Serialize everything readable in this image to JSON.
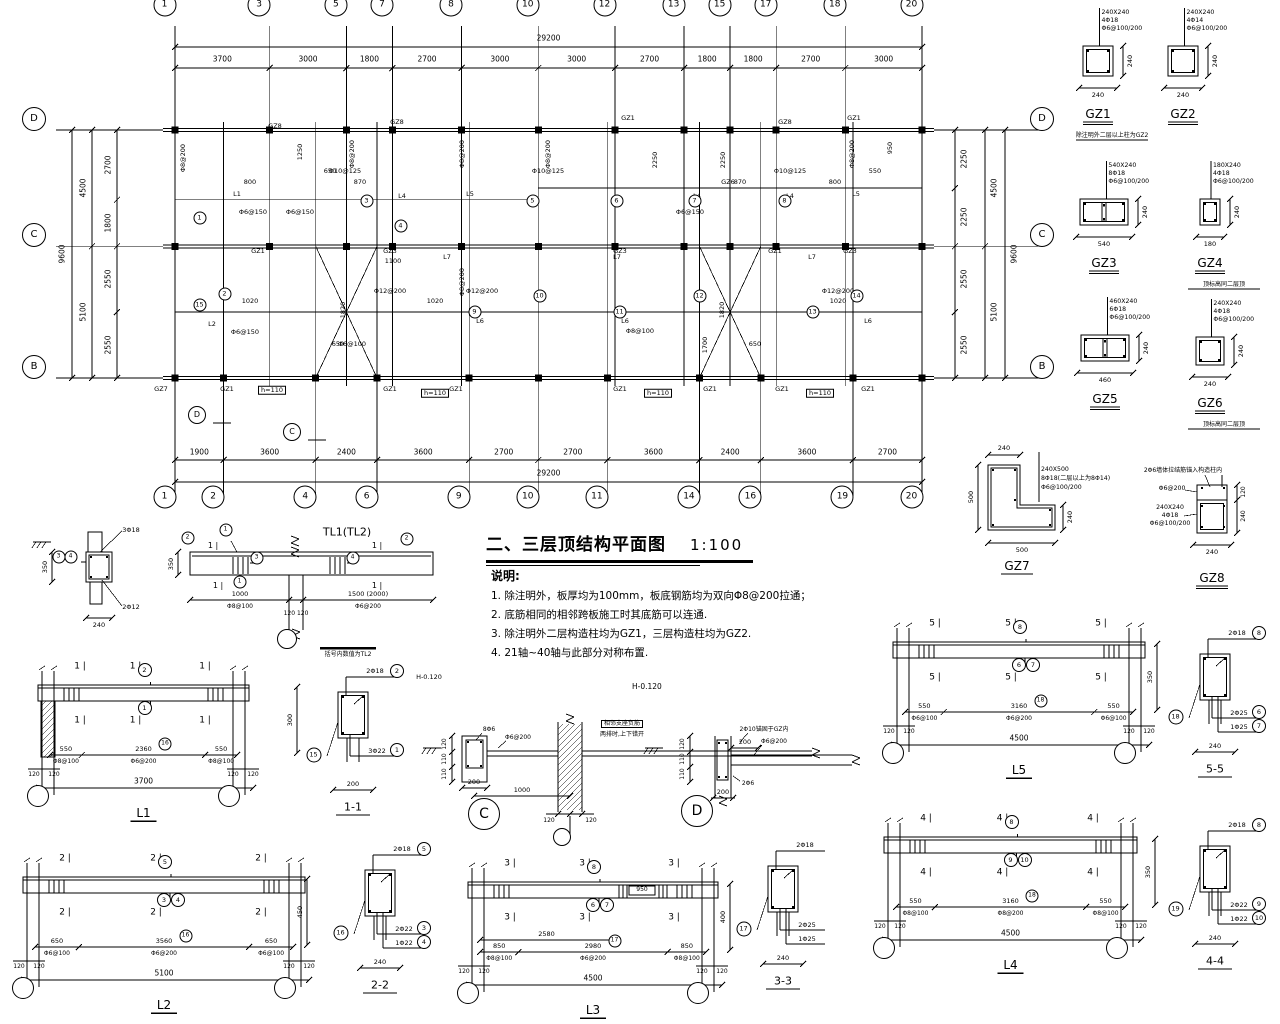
{
  "title": {
    "text": "二、三层顶结构平面图",
    "scale": "1:100"
  },
  "notes": {
    "heading": "说明:",
    "items": [
      "1. 除注明外，板厚均为100mm，板底钢筋均为双向Φ8@200拉通；",
      "2. 底筋相同的相邻跨板施工时其底筋可以连通.",
      "3. 除注明外二层构造柱均为GZ1，三层构造柱均为GZ2.",
      "4. 21轴~40轴与此部分对称布置."
    ],
    "elevation_note": "H-0.120"
  },
  "plan": {
    "total_dim": "29200",
    "height_dim": "9600",
    "top_bounds": [
      0,
      3700,
      6700,
      8500,
      11200,
      14200,
      17200,
      19900,
      21700,
      23500,
      26200,
      29200
    ],
    "top_axes": [
      "1",
      "3",
      "5",
      "7",
      "8",
      "10",
      "12",
      "13",
      "15",
      "17",
      "18",
      "20"
    ],
    "top_dims": [
      "3700",
      "3000",
      "1800",
      "2700",
      "3000",
      "3000",
      "2700",
      "1800",
      "1800",
      "2700",
      "3000"
    ],
    "bottom_bounds": [
      0,
      1900,
      5500,
      7900,
      11500,
      14200,
      16900,
      20500,
      22900,
      26500,
      29200
    ],
    "bottom_axes": [
      "1",
      "2",
      "4",
      "6",
      "9",
      "10",
      "11",
      "14",
      "16",
      "19",
      "20"
    ],
    "bottom_dims": [
      "1900",
      "3600",
      "2400",
      "3600",
      "2700",
      "2700",
      "3600",
      "2400",
      "3600",
      "2700"
    ],
    "side_axes": [
      "D",
      "C",
      "B"
    ],
    "side_mm": [
      0,
      4500,
      9600
    ],
    "left_outer": {
      "bounds": [
        0,
        4500,
        9600
      ],
      "labels": [
        "4500",
        "5100"
      ]
    },
    "left_inner": {
      "bounds": [
        0,
        2700,
        4500,
        7050,
        9600
      ],
      "labels": [
        "2700",
        "1800",
        "2550",
        "2550"
      ]
    },
    "right_inner": {
      "bounds": [
        0,
        2250,
        4500,
        7050,
        9600
      ],
      "labels": [
        "2250",
        "2250",
        "2550",
        "2550"
      ]
    },
    "right_outer": {
      "bounds": [
        0,
        4500,
        9600
      ],
      "labels": [
        "4500",
        "5100"
      ]
    },
    "stair_panels": [
      [
        5500,
        7900
      ],
      [
        20500,
        22900
      ]
    ],
    "annotations": [
      {
        "t": "GZ8",
        "x": 100,
        "y": -4
      },
      {
        "t": "GZ8",
        "x": 222,
        "y": -8
      },
      {
        "t": "GZ1",
        "x": 453,
        "y": -12
      },
      {
        "t": "GZ8",
        "x": 610,
        "y": -8
      },
      {
        "t": "GZ1",
        "x": 679,
        "y": -12
      },
      {
        "t": "L1",
        "x": 62,
        "y": 64
      },
      {
        "t": "L4",
        "x": 227,
        "y": 66
      },
      {
        "t": "L5",
        "x": 295,
        "y": 64
      },
      {
        "t": "L4",
        "x": 522,
        "y": 66
      },
      {
        "t": "GZ6",
        "x": 553,
        "y": 52
      },
      {
        "t": "L4",
        "x": 615,
        "y": 66
      },
      {
        "t": "L5",
        "x": 681,
        "y": 64
      },
      {
        "t": "GZ1",
        "x": 83,
        "y": 121
      },
      {
        "t": "GZ3",
        "x": 215,
        "y": 121
      },
      {
        "t": "GZ3",
        "x": 445,
        "y": 121
      },
      {
        "t": "GZ1",
        "x": 600,
        "y": 121
      },
      {
        "t": "GZ3",
        "x": 675,
        "y": 121
      },
      {
        "t": "L7",
        "x": 272,
        "y": 127
      },
      {
        "t": "L7",
        "x": 442,
        "y": 127
      },
      {
        "t": "L7",
        "x": 637,
        "y": 127
      },
      {
        "t": "L2",
        "x": 37,
        "y": 194
      },
      {
        "t": "L6",
        "x": 305,
        "y": 191
      },
      {
        "t": "L6",
        "x": 450,
        "y": 191
      },
      {
        "t": "L6",
        "x": 693,
        "y": 191
      },
      {
        "t": "GZ7",
        "x": -14,
        "y": 259
      },
      {
        "t": "GZ1",
        "x": 52,
        "y": 259
      },
      {
        "t": "GZ1",
        "x": 215,
        "y": 259
      },
      {
        "t": "GZ1",
        "x": 281,
        "y": 259
      },
      {
        "t": "GZ1",
        "x": 445,
        "y": 259
      },
      {
        "t": "GZ1",
        "x": 535,
        "y": 259
      },
      {
        "t": "GZ1",
        "x": 607,
        "y": 259
      },
      {
        "t": "GZ1",
        "x": 693,
        "y": 259
      },
      {
        "t": "h=110",
        "x": 97,
        "y": 260,
        "b": 1
      },
      {
        "t": "h=110",
        "x": 260,
        "y": 263,
        "b": 1
      },
      {
        "t": "h=110",
        "x": 483,
        "y": 263,
        "b": 1
      },
      {
        "t": "h=110",
        "x": 645,
        "y": 263,
        "b": 1
      },
      {
        "t": "Φ8@200",
        "x": 8,
        "y": 28,
        "r": 1
      },
      {
        "t": "Φ8@200",
        "x": 177,
        "y": 24,
        "r": 1
      },
      {
        "t": "Φ8@200",
        "x": 287,
        "y": 24,
        "r": 1
      },
      {
        "t": "Φ8@200",
        "x": 373,
        "y": 24,
        "r": 1
      },
      {
        "t": "Φ8@200",
        "x": 677,
        "y": 24,
        "r": 1
      },
      {
        "t": "Φ8@200",
        "x": 287,
        "y": 152,
        "r": 1
      },
      {
        "t": "Φ10@125",
        "x": 170,
        "y": 41
      },
      {
        "t": "Φ10@125",
        "x": 373,
        "y": 41
      },
      {
        "t": "Φ10@125",
        "x": 615,
        "y": 41
      },
      {
        "t": "Φ6@150",
        "x": 78,
        "y": 82
      },
      {
        "t": "Φ6@150",
        "x": 125,
        "y": 82
      },
      {
        "t": "Φ6@150",
        "x": 515,
        "y": 82
      },
      {
        "t": "Φ12@200",
        "x": 215,
        "y": 161
      },
      {
        "t": "Φ12@200",
        "x": 307,
        "y": 161
      },
      {
        "t": "Φ12@200",
        "x": 663,
        "y": 161
      },
      {
        "t": "Φ8@100",
        "x": 465,
        "y": 201
      },
      {
        "t": "Φ6@100",
        "x": 177,
        "y": 214
      },
      {
        "t": "Φ6@150",
        "x": 70,
        "y": 202
      },
      {
        "t": "800",
        "x": 75,
        "y": 52
      },
      {
        "t": "870",
        "x": 185,
        "y": 52
      },
      {
        "t": "870",
        "x": 565,
        "y": 52
      },
      {
        "t": "800",
        "x": 660,
        "y": 52
      },
      {
        "t": "650",
        "x": 155,
        "y": 41
      },
      {
        "t": "650",
        "x": 163,
        "y": 214
      },
      {
        "t": "650",
        "x": 580,
        "y": 214
      },
      {
        "t": "1020",
        "x": 75,
        "y": 171
      },
      {
        "t": "1020",
        "x": 260,
        "y": 171
      },
      {
        "t": "1020",
        "x": 663,
        "y": 171
      },
      {
        "t": "1100",
        "x": 218,
        "y": 131
      },
      {
        "t": "550",
        "x": 700,
        "y": 41
      },
      {
        "t": "1250",
        "x": 125,
        "y": 22,
        "r": 1
      },
      {
        "t": "950",
        "x": 715,
        "y": 18,
        "r": 1
      },
      {
        "t": "2250",
        "x": 480,
        "y": 30,
        "r": 1
      },
      {
        "t": "2250",
        "x": 548,
        "y": 30,
        "r": 1
      },
      {
        "t": "1820",
        "x": 168,
        "y": 180,
        "r": 1
      },
      {
        "t": "1820",
        "x": 547,
        "y": 180,
        "r": 1
      },
      {
        "t": "1700",
        "x": 530,
        "y": 215,
        "r": 1
      },
      {
        "t": "1",
        "x": 30,
        "y": 93,
        "c": 1
      },
      {
        "t": "3",
        "x": 197,
        "y": 76,
        "c": 1
      },
      {
        "t": "4",
        "x": 231,
        "y": 101,
        "c": 1
      },
      {
        "t": "5",
        "x": 363,
        "y": 76,
        "c": 1
      },
      {
        "t": "6",
        "x": 447,
        "y": 76,
        "c": 1
      },
      {
        "t": "7",
        "x": 525,
        "y": 76,
        "c": 1
      },
      {
        "t": "8",
        "x": 615,
        "y": 76,
        "c": 1
      },
      {
        "t": "2",
        "x": 55,
        "y": 169,
        "c": 1
      },
      {
        "t": "9",
        "x": 305,
        "y": 187,
        "c": 1
      },
      {
        "t": "10",
        "x": 370,
        "y": 171,
        "c": 1
      },
      {
        "t": "11",
        "x": 450,
        "y": 187,
        "c": 1
      },
      {
        "t": "12",
        "x": 530,
        "y": 171,
        "c": 1
      },
      {
        "t": "13",
        "x": 643,
        "y": 187,
        "c": 1
      },
      {
        "t": "14",
        "x": 687,
        "y": 171,
        "c": 1
      },
      {
        "t": "15",
        "x": 30,
        "y": 180,
        "c": 1
      }
    ],
    "cut_bubbles": [
      {
        "t": "D",
        "x": 30,
        "y": 293
      },
      {
        "t": "C",
        "x": 125,
        "y": 310
      }
    ]
  },
  "column_details": [
    {
      "id": "GZ1",
      "x": 1083,
      "y": 46,
      "w": 30,
      "h": 30,
      "cells": 1,
      "spec": [
        "240X240",
        "4Φ18",
        "Φ6@100/200"
      ],
      "wdim": "240",
      "hdim": "240",
      "note": "除注明外二层以上柱为GZ2"
    },
    {
      "id": "GZ2",
      "x": 1168,
      "y": 46,
      "w": 30,
      "h": 30,
      "cells": 1,
      "spec": [
        "240X240",
        "4Φ14",
        "Φ6@100/200"
      ],
      "wdim": "240",
      "hdim": "240"
    },
    {
      "id": "GZ3",
      "x": 1080,
      "y": 199,
      "w": 48,
      "h": 26,
      "cells": 2,
      "spec": [
        "540X240",
        "8Φ18",
        "Φ6@100/200"
      ],
      "wdim": "540",
      "hdim": "240"
    },
    {
      "id": "GZ4",
      "x": 1200,
      "y": 199,
      "w": 20,
      "h": 26,
      "cells": 1,
      "spec": [
        "180X240",
        "4Φ18",
        "Φ6@100/200"
      ],
      "wdim": "180",
      "hdim": "240",
      "note": "顶标高同二层顶"
    },
    {
      "id": "GZ5",
      "x": 1081,
      "y": 335,
      "w": 48,
      "h": 26,
      "cells": 2,
      "spec": [
        "460X240",
        "6Φ18",
        "Φ6@100/200"
      ],
      "wdim": "460",
      "hdim": "240"
    },
    {
      "id": "GZ6",
      "x": 1196,
      "y": 337,
      "w": 28,
      "h": 28,
      "cells": 1,
      "spec": [
        "240X240",
        "4Φ18",
        "Φ6@100/200"
      ],
      "wdim": "240",
      "hdim": "240",
      "note": "顶标高同二层顶"
    }
  ],
  "gz7": {
    "id": "GZ7",
    "spec": [
      "240X500",
      "8Φ18(二层以上为8Φ14)",
      "Φ6@100/200"
    ],
    "dim_top": "240",
    "dim_left": "500",
    "dim_bottom": "500",
    "dim_right": "240"
  },
  "gz8": {
    "id": "GZ8",
    "leader_note": "2Φ6墙体拉结筋锚入构造柱内",
    "tie": "Φ6@200",
    "spec": [
      "240X240",
      "4Φ18",
      "Φ6@100/200"
    ],
    "dim_r1": "120",
    "dim_r2": "240",
    "dim_bottom": "240"
  },
  "tl_detail": {
    "title": "TL1(TL2)",
    "top_rebar": "3Φ18",
    "bot_rebar": "2Φ12",
    "sec_h": "350",
    "sec_w": "240",
    "sec_circles": [
      "3",
      "4"
    ],
    "elev_dim_left": "350",
    "span1": "1000",
    "span1_rebar": "Φ8@100",
    "span2": "1500 (2000)",
    "span2_rebar": "Φ6@200",
    "wall_dims": "120 120",
    "note": "括号内数值为TL2",
    "marker": "1",
    "c_top_left": "2",
    "c_top_mid": "1",
    "c_top_right": "2",
    "c_st_left": "3",
    "c_st_right": "4",
    "c_bot": "1"
  },
  "beam_details": [
    {
      "id": "L1",
      "x": 26,
      "y": 655,
      "w": 235,
      "marker": "1",
      "top_circle": "2",
      "mid_circles": [
        "1"
      ],
      "segs": [
        {
          "d": "550",
          "r": "Φ8@100"
        },
        {
          "d": "2360",
          "r": "Φ6@200"
        },
        {
          "d": "550",
          "r": "Φ8@100"
        }
      ],
      "slab_circle": "16",
      "total": "3700",
      "right_dim": "300",
      "rdx": 36,
      "wall_left": true
    },
    {
      "id": "L2",
      "x": 11,
      "y": 847,
      "w": 306,
      "marker": "2",
      "top_circle": "5",
      "mid_circles": [
        "3",
        "4"
      ],
      "segs": [
        {
          "d": "650",
          "r": "Φ6@100"
        },
        {
          "d": "3560",
          "r": "Φ6@200"
        },
        {
          "d": "650",
          "r": "Φ6@100"
        }
      ],
      "slab_circle": "16",
      "total": "5100",
      "right_dim": "450",
      "rdx": -10
    },
    {
      "id": "L3",
      "x": 456,
      "y": 852,
      "w": 274,
      "marker": "3",
      "top_circle": "8",
      "mid_circles": [
        "6",
        "7"
      ],
      "segs": [
        {
          "d": "850",
          "r": "Φ8@100"
        },
        {
          "d": "2980",
          "r": "Φ6@200"
        },
        {
          "d": "850",
          "r": "Φ8@100"
        }
      ],
      "slab_circle": "17",
      "total": "4500",
      "right_dim": "400",
      "rdx": 0,
      "extra_top_dim": "2580",
      "beam_dim": "950"
    },
    {
      "id": "L5",
      "x": 881,
      "y": 612,
      "w": 276,
      "marker": "5",
      "top_circle": "8",
      "mid_circles": [
        "6",
        "7"
      ],
      "segs": [
        {
          "d": "550",
          "r": "Φ6@100"
        },
        {
          "d": "3160",
          "r": "Φ6@200"
        },
        {
          "d": "550",
          "r": "Φ6@100"
        }
      ],
      "slab_circle": "18",
      "total": "4500",
      "right_dim": "350",
      "rdx": 0
    },
    {
      "id": "L4",
      "x": 872,
      "y": 807,
      "w": 277,
      "marker": "4",
      "top_circle": "8",
      "mid_circles": [
        "9",
        "10"
      ],
      "segs": [
        {
          "d": "550",
          "r": "Φ8@100"
        },
        {
          "d": "3160",
          "r": "Φ8@200"
        },
        {
          "d": "550",
          "r": "Φ8@100"
        }
      ],
      "slab_circle": "18",
      "total": "4500",
      "right_dim": "350",
      "rdx": 6
    }
  ],
  "sections": [
    {
      "id": "1-1",
      "x": 315,
      "y": 660,
      "top": "2Φ18",
      "top_circle": "2",
      "note": "H-0.120",
      "bots": [
        {
          "t": "3Φ22",
          "c": "1"
        }
      ],
      "left_circle": "15",
      "dim": "200"
    },
    {
      "id": "2-2",
      "x": 342,
      "y": 838,
      "top": "2Φ18",
      "top_circle": "5",
      "bots": [
        {
          "t": "2Φ22",
          "c": "3"
        },
        {
          "t": "1Φ22",
          "c": "4"
        }
      ],
      "left_circle": "16",
      "dim": "240"
    },
    {
      "id": "3-3",
      "x": 745,
      "y": 834,
      "top": "2Φ18",
      "bots": [
        {
          "t": "2Φ25",
          "c": ""
        },
        {
          "t": "1Φ25",
          "c": ""
        }
      ],
      "left_circle": "17",
      "dim": "240"
    },
    {
      "id": "5-5",
      "x": 1177,
      "y": 622,
      "top": "2Φ18",
      "top_circle": "8",
      "bots": [
        {
          "t": "2Φ25",
          "c": "6"
        },
        {
          "t": "1Φ25",
          "c": "7"
        }
      ],
      "left_circle": "18",
      "dim": "240"
    },
    {
      "id": "4-4",
      "x": 1177,
      "y": 814,
      "top": "2Φ18",
      "top_circle": "8",
      "bots": [
        {
          "t": "2Φ22",
          "c": "9"
        },
        {
          "t": "1Φ22",
          "c": "10"
        }
      ],
      "left_circle": "19",
      "dim": "240"
    }
  ],
  "c_detail": {
    "bubble": "C",
    "top_rebar": "8Φ6",
    "tie": "Φ6@200",
    "left_dims": [
      "120",
      "110",
      "110"
    ],
    "width_dim": "200",
    "span_dim": "1000",
    "wall_dims": [
      "120",
      "120"
    ],
    "note_line1": "相邻支座负筋",
    "note_line2": "两排时,上下错开"
  },
  "d_detail": {
    "bubble": "D",
    "anchor_note": "2Φ10锚固于GZ内",
    "tie": "Φ6@200",
    "top_dim": "200",
    "left_dims": [
      "120",
      "110",
      "110"
    ],
    "bot_rebar": "2Φ6",
    "bottom_dim": "200"
  }
}
